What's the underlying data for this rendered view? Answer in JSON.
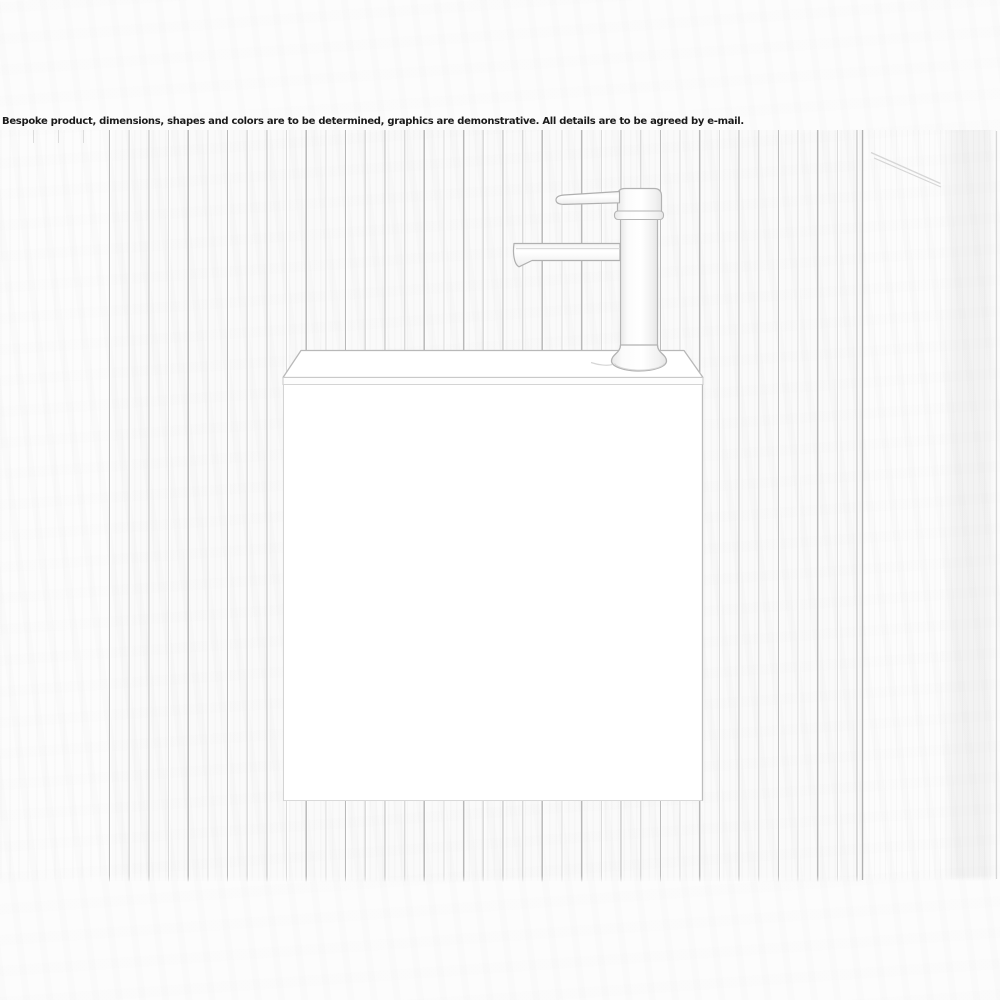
{
  "disclaimer": "Bespoke product, dimensions, shapes and colors are to be determined, graphics are demonstrative. All details are to be agreed by e-mail.",
  "colors": {
    "background": "#fcfcfc",
    "wall_line": "#b3b3b3",
    "sketch_line": "#b0b0b0",
    "faint_line": "#d6d6d6",
    "shading": "#ececec",
    "text": "#1b1b1b"
  },
  "scene": {
    "objects": [
      {
        "name": "slat-wall",
        "label": "vertical slat wall panelling"
      },
      {
        "name": "washbasin-cabinet",
        "label": "wall-hung washbasin cabinet, white"
      },
      {
        "name": "mixer-tap",
        "label": "tall single-lever basin mixer tap"
      },
      {
        "name": "right-side-wall",
        "label": "plain side wall at right"
      },
      {
        "name": "towel-rail",
        "label": "diagonal rail on side wall, top right"
      }
    ]
  }
}
